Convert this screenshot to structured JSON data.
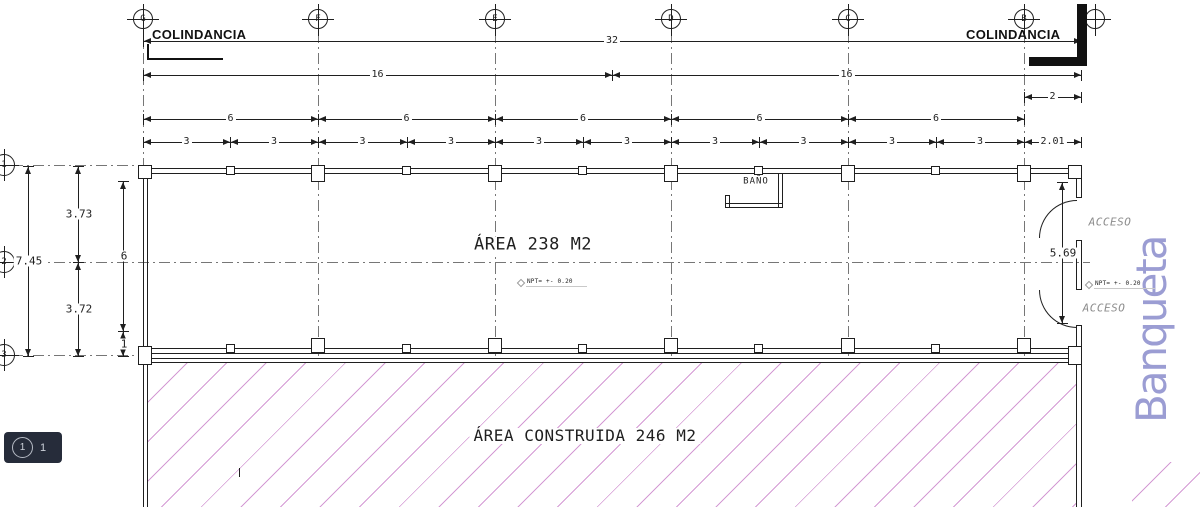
{
  "labels": {
    "colindancia_left": "COLINDANCIA",
    "colindancia_right": "COLINDANCIA",
    "area_main": "ÁREA 238 M2",
    "area_construida": "ÁREA CONSTRUIDA 246 M2",
    "bano": "BAÑO",
    "acceso_upper": "ACCESO",
    "acceso_lower": "ACCESO",
    "npt_center": "NPT= +- 0.20",
    "npt_right": "NPT= +- 0.20",
    "banqueta": "Banqueta"
  },
  "badge": {
    "circle_label": "1",
    "value": "1"
  },
  "colors": {
    "hatch": "#d49ad4",
    "banqueta": "#9b9dd3",
    "badge_bg": "#262c3a",
    "badge_text": "#ccd1d9",
    "line": "#1f1f1f",
    "acceso": "#8d8d8d",
    "faint": "#b5b5b5"
  },
  "grid_bubbles": {
    "top": [
      {
        "label": "G",
        "x": 143
      },
      {
        "label": "F",
        "x": 318
      },
      {
        "label": "E",
        "x": 495
      },
      {
        "label": "D",
        "x": 671
      },
      {
        "label": "C",
        "x": 848
      },
      {
        "label": "B",
        "x": 1024
      },
      {
        "label": "",
        "x": 1095
      }
    ],
    "left": [
      {
        "label": "1",
        "y": 165
      },
      {
        "label": "2",
        "y": 262
      },
      {
        "label": "3",
        "y": 355
      }
    ]
  },
  "grid_lines_v": [
    143,
    318,
    495,
    671,
    848,
    1024
  ],
  "grid_lines_h": [
    {
      "y": 165,
      "x1": 12,
      "x2": 143
    },
    {
      "y": 262,
      "x1": 12,
      "x2": 1090
    },
    {
      "y": 355,
      "x1": 12,
      "x2": 143
    }
  ],
  "dims_h": [
    {
      "label": "32",
      "x1": 143,
      "x2": 1081,
      "y": 41
    },
    {
      "label": "16",
      "x1": 143,
      "x2": 612,
      "y": 75
    },
    {
      "label": "16",
      "x1": 612,
      "x2": 1081,
      "y": 75
    },
    {
      "label": "2",
      "x1": 1024,
      "x2": 1081,
      "y": 97
    },
    {
      "label": "6",
      "x1": 143,
      "x2": 318,
      "y": 119
    },
    {
      "label": "6",
      "x1": 318,
      "x2": 495,
      "y": 119
    },
    {
      "label": "6",
      "x1": 495,
      "x2": 671,
      "y": 119
    },
    {
      "label": "6",
      "x1": 671,
      "x2": 848,
      "y": 119
    },
    {
      "label": "6",
      "x1": 848,
      "x2": 1024,
      "y": 119
    },
    {
      "label": "3",
      "x1": 143,
      "x2": 230,
      "y": 142
    },
    {
      "label": "3",
      "x1": 230,
      "x2": 318,
      "y": 142
    },
    {
      "label": "3",
      "x1": 318,
      "x2": 407,
      "y": 142
    },
    {
      "label": "3",
      "x1": 407,
      "x2": 495,
      "y": 142
    },
    {
      "label": "3",
      "x1": 495,
      "x2": 583,
      "y": 142
    },
    {
      "label": "3",
      "x1": 583,
      "x2": 671,
      "y": 142
    },
    {
      "label": "3",
      "x1": 671,
      "x2": 759,
      "y": 142
    },
    {
      "label": "3",
      "x1": 759,
      "x2": 848,
      "y": 142
    },
    {
      "label": "3",
      "x1": 848,
      "x2": 936,
      "y": 142
    },
    {
      "label": "3",
      "x1": 936,
      "x2": 1024,
      "y": 142
    },
    {
      "label": "2.01",
      "x1": 1024,
      "x2": 1081,
      "y": 142
    }
  ],
  "dims_v": [
    {
      "label": "7.45",
      "y1": 166,
      "y2": 356,
      "x": 28
    },
    {
      "label": "3.73",
      "y1": 166,
      "y2": 262,
      "x": 78
    },
    {
      "label": "3.72",
      "y1": 262,
      "y2": 356,
      "x": 78
    },
    {
      "label": "6",
      "y1": 181,
      "y2": 331,
      "x": 123
    },
    {
      "label": "1",
      "y1": 331,
      "y2": 356,
      "x": 123
    },
    {
      "label": "5.69",
      "y1": 182,
      "y2": 323,
      "x": 1062
    }
  ],
  "walls": [
    {
      "x": 143,
      "y": 168,
      "w": 938,
      "h": 1
    },
    {
      "x": 143,
      "y": 173,
      "w": 938,
      "h": 1
    },
    {
      "x": 143,
      "y": 348,
      "w": 938,
      "h": 1
    },
    {
      "x": 143,
      "y": 353,
      "w": 938,
      "h": 1
    },
    {
      "x": 143,
      "y": 358,
      "w": 938,
      "h": 1
    },
    {
      "x": 143,
      "y": 362,
      "w": 938,
      "h": 1
    },
    {
      "x": 143,
      "y": 168,
      "w": 1,
      "h": 339
    },
    {
      "x": 147,
      "y": 168,
      "w": 1,
      "h": 339
    },
    {
      "x": 1076,
      "y": 168,
      "w": 1,
      "h": 30
    },
    {
      "x": 1081,
      "y": 168,
      "w": 1,
      "h": 30
    },
    {
      "x": 1076,
      "y": 240,
      "w": 1,
      "h": 50
    },
    {
      "x": 1081,
      "y": 240,
      "w": 1,
      "h": 50
    },
    {
      "x": 1076,
      "y": 325,
      "w": 1,
      "h": 182
    },
    {
      "x": 1081,
      "y": 325,
      "w": 1,
      "h": 182
    },
    {
      "x": 1076,
      "y": 197,
      "w": 6,
      "h": 1
    },
    {
      "x": 1076,
      "y": 240,
      "w": 6,
      "h": 1
    },
    {
      "x": 1076,
      "y": 289,
      "w": 6,
      "h": 1
    },
    {
      "x": 1076,
      "y": 325,
      "w": 6,
      "h": 1
    },
    {
      "x": 778,
      "y": 173,
      "w": 1,
      "h": 34
    },
    {
      "x": 782,
      "y": 173,
      "w": 1,
      "h": 34
    },
    {
      "x": 725,
      "y": 203,
      "w": 58,
      "h": 1
    },
    {
      "x": 725,
      "y": 207,
      "w": 58,
      "h": 1
    },
    {
      "x": 725,
      "y": 195,
      "w": 1,
      "h": 12
    },
    {
      "x": 729,
      "y": 195,
      "w": 1,
      "h": 12
    },
    {
      "x": 725,
      "y": 195,
      "w": 5,
      "h": 1
    },
    {
      "x": 239,
      "y": 468,
      "w": 1,
      "h": 9
    }
  ],
  "columns": [
    {
      "x": 138,
      "y": 165,
      "w": 14,
      "h": 14
    },
    {
      "x": 1068,
      "y": 165,
      "w": 14,
      "h": 14
    },
    {
      "x": 138,
      "y": 346,
      "w": 14,
      "h": 19
    },
    {
      "x": 1068,
      "y": 346,
      "w": 14,
      "h": 19
    },
    {
      "x": 311,
      "y": 165,
      "w": 14,
      "h": 17
    },
    {
      "x": 488,
      "y": 165,
      "w": 14,
      "h": 17
    },
    {
      "x": 664,
      "y": 165,
      "w": 14,
      "h": 17
    },
    {
      "x": 841,
      "y": 165,
      "w": 14,
      "h": 17
    },
    {
      "x": 1017,
      "y": 165,
      "w": 14,
      "h": 17
    },
    {
      "x": 226,
      "y": 166,
      "w": 9,
      "h": 9
    },
    {
      "x": 402,
      "y": 166,
      "w": 9,
      "h": 9
    },
    {
      "x": 578,
      "y": 166,
      "w": 9,
      "h": 9
    },
    {
      "x": 754,
      "y": 166,
      "w": 9,
      "h": 9
    },
    {
      "x": 931,
      "y": 166,
      "w": 9,
      "h": 9
    },
    {
      "x": 311,
      "y": 338,
      "w": 14,
      "h": 15
    },
    {
      "x": 488,
      "y": 338,
      "w": 14,
      "h": 15
    },
    {
      "x": 664,
      "y": 338,
      "w": 14,
      "h": 15
    },
    {
      "x": 841,
      "y": 338,
      "w": 14,
      "h": 15
    },
    {
      "x": 1017,
      "y": 338,
      "w": 14,
      "h": 15
    },
    {
      "x": 226,
      "y": 344,
      "w": 9,
      "h": 9
    },
    {
      "x": 402,
      "y": 344,
      "w": 9,
      "h": 9
    },
    {
      "x": 578,
      "y": 344,
      "w": 9,
      "h": 9
    },
    {
      "x": 754,
      "y": 344,
      "w": 9,
      "h": 9
    },
    {
      "x": 931,
      "y": 344,
      "w": 9,
      "h": 9
    }
  ],
  "doors": [
    {
      "x": 1039,
      "y": 200,
      "size": 37,
      "corner": "tl"
    },
    {
      "x": 1039,
      "y": 290,
      "size": 37,
      "corner": "bl"
    }
  ],
  "hatch_area": {
    "x": 148,
    "y": 363,
    "w": 928,
    "h": 144
  },
  "hatch_corner": {
    "x": 1132,
    "y": 462,
    "w": 68,
    "h": 45
  },
  "boundary_markers": {
    "left_v": {
      "x": 147,
      "y": 44,
      "w": 2,
      "h": 16
    },
    "left_h": {
      "x": 147,
      "y": 58,
      "w": 76,
      "h": 2
    },
    "right_v": {
      "x": 1077,
      "y": 4,
      "w": 10,
      "h": 62
    },
    "right_h": {
      "x": 1029,
      "y": 57,
      "w": 58,
      "h": 9
    }
  }
}
